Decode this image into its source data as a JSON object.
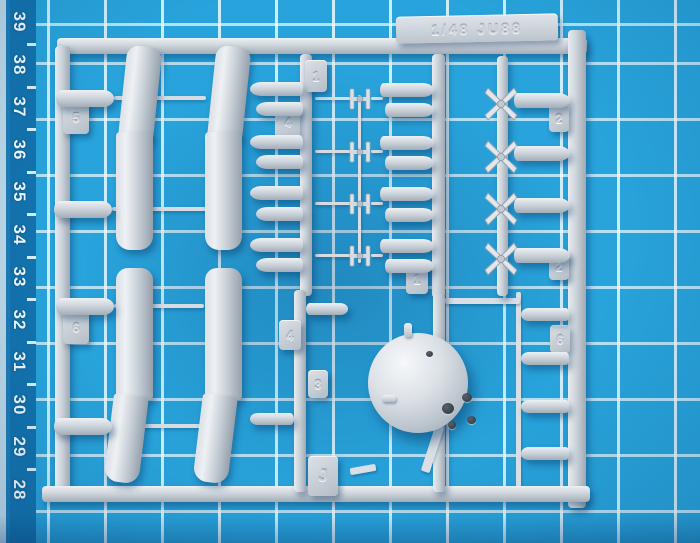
{
  "mat": {
    "ruler_numbers": [
      "39",
      "38",
      "37",
      "36",
      "35",
      "34",
      "33",
      "32",
      "31",
      "30",
      "29",
      "28"
    ],
    "surface_color": "#28a3db",
    "grid_line_color": "#cdeef8",
    "ruler_strip_color": "#1373ae",
    "ruler_text_color": "#eef9ff"
  },
  "sprue": {
    "title_label": "1/48 JU88",
    "plastic_color": "#ccd3da",
    "tabs": {
      "upper_left": "5",
      "mid_top": "1",
      "mid_left": "4",
      "right_upper": "2",
      "right_lower": "2",
      "center": "1",
      "lower_runner_left": "4",
      "lower_runner_mid": "3",
      "lower_runner_letter": "J",
      "lower_left": "6",
      "lower_right": "6"
    }
  }
}
